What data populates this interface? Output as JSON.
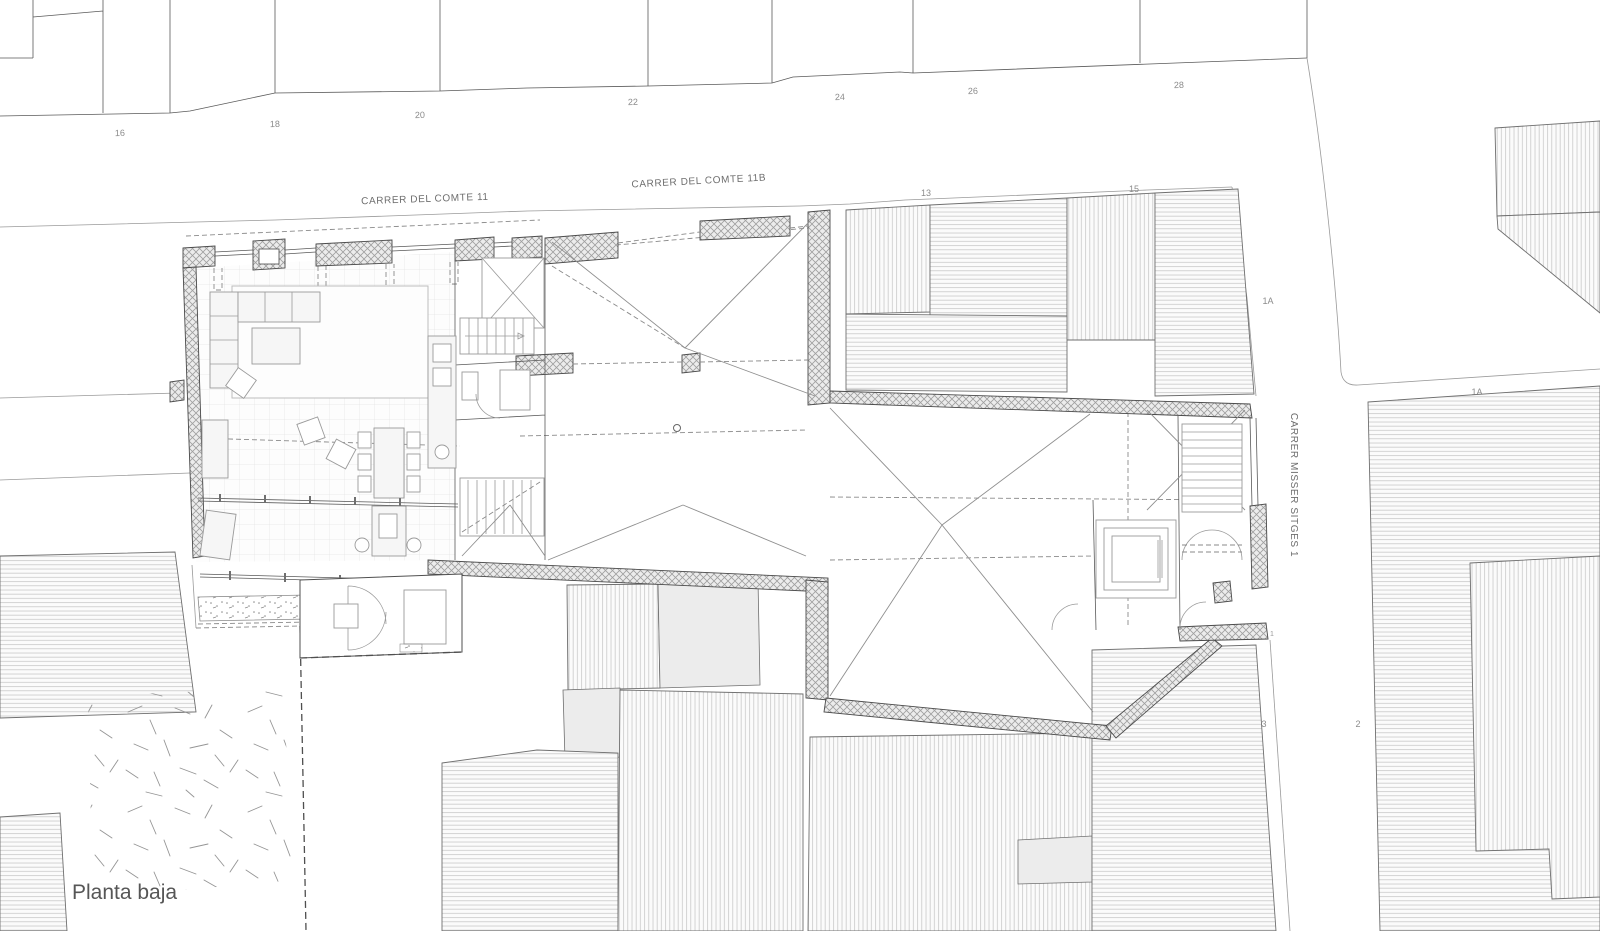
{
  "plan": {
    "title": "Planta baja"
  },
  "streets": {
    "comte_11": "CARRER DEL COMTE 11",
    "comte_11b": "CARRER DEL COMTE 11B",
    "misser_sitges": "CARRER MISSER SITGES 1"
  },
  "house_numbers": {
    "north": [
      "16",
      "18",
      "20",
      "22",
      "24",
      "26",
      "28"
    ],
    "south": [
      "13",
      "15"
    ],
    "east": [
      "1A",
      "1A",
      "1",
      "2",
      "3"
    ]
  },
  "colors": {
    "background": "#ffffff",
    "main_line": "#4a4a4a",
    "thin_line": "#9a9a9a",
    "wall_hatch": "#9f9f9f",
    "wall_fill": "#ececec",
    "building_hatch": "#c6c6c6",
    "parcel_fill": "#ececec",
    "text": "#6e6e6e"
  }
}
